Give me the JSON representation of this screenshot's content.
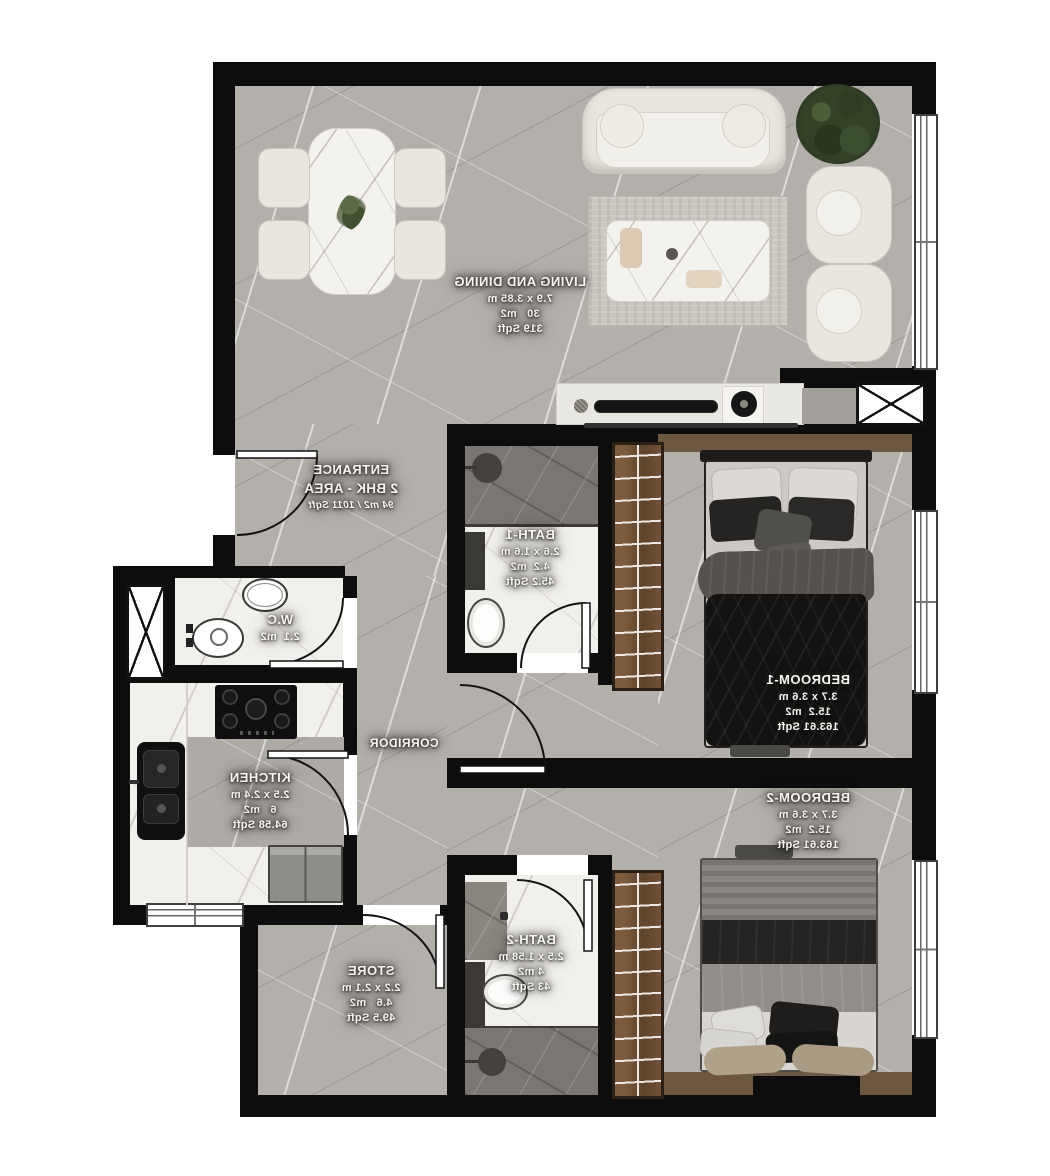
{
  "plan_type": "apartment-floor-plan",
  "text_direction": "mirrored",
  "rooms": {
    "living": {
      "name": "LIVING AND DINING",
      "dims": "7.9 x 3.85 m",
      "area_m2": "30   m2",
      "area_sqft": "319 Sqft"
    },
    "entrance": {
      "name": "ENTRANCE",
      "unit_type": "2 BHK - AREA",
      "unit_area": "94 m2 / 1011 Sqft"
    },
    "bath1": {
      "name": "BATH-1",
      "dims": "2.6 x 1.6 m",
      "area_m2": "4.2  m2",
      "area_sqft": "45.2 Sqft"
    },
    "bedroom1": {
      "name": "BEDROOM-1",
      "dims": "3.7 x 3.6 m",
      "area_m2": "15.2  m2",
      "area_sqft": "163.61 Sqft"
    },
    "bedroom2": {
      "name": "BEDROOM-2",
      "dims": "3.7 x 3.6 m",
      "area_m2": "15.2  m2",
      "area_sqft": "163.61 Sqft"
    },
    "wc": {
      "name": "W.C",
      "area_m2": "2.1  m2"
    },
    "kitchen": {
      "name": "KITCHEN",
      "dims": "2.5 x 2.4 m",
      "area_m2": "6   m2",
      "area_sqft": "64.58 Sqft"
    },
    "corridor": {
      "name": "CORRIDOR"
    },
    "store": {
      "name": "STORE",
      "dims": "2.2 x 2.1 m",
      "area_m2": "4.6   m2",
      "area_sqft": "49.5 Sqft"
    },
    "bath2": {
      "name": "BATH-2",
      "dims": "2.5 x 1.58 m",
      "area_m2": "4 m2",
      "area_sqft": "43 Sqft"
    }
  },
  "colors": {
    "wall": "#0d0d0d",
    "floor_gray": "#b3afab",
    "floor_white": "#f2f0ed",
    "wood_wardrobe": "#6b4e33",
    "wood_threshold": "#6d5741",
    "label_text": "#f8f7f5",
    "sofa_cream": "#e9e6df",
    "plant_green": "#334127"
  }
}
